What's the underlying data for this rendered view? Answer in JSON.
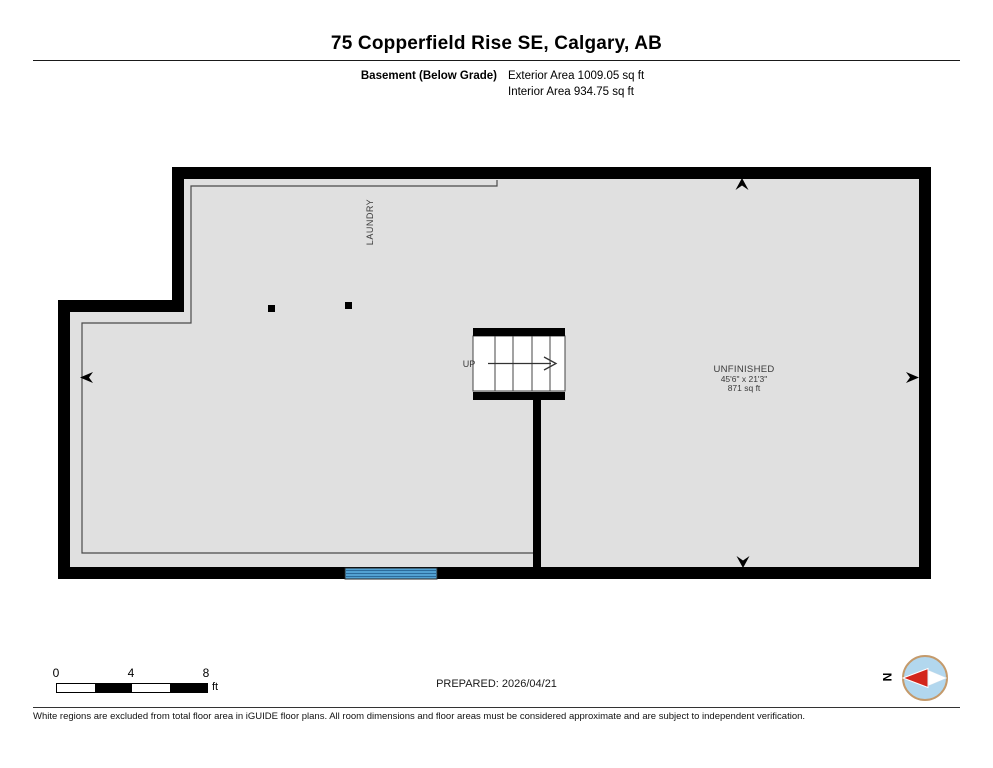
{
  "header": {
    "title": "75 Copperfield Rise SE, Calgary, AB",
    "floor_label": "Basement (Below Grade)",
    "exterior_area": "Exterior Area 1009.05 sq ft",
    "interior_area": "Interior Area 934.75 sq ft"
  },
  "plan": {
    "rooms": {
      "laundry": {
        "label": "LAUNDRY"
      },
      "unfinished": {
        "label": "UNFINISHED",
        "dimensions": "45'6\" x 21'3\"",
        "area": "871 sq ft"
      },
      "stairs": {
        "direction_label": "UP"
      }
    }
  },
  "colors": {
    "wall": "#000000",
    "floor_fill": "#e0e0e0",
    "interior_line": "#4a4a4a",
    "window_fill": "#58a9da",
    "window_stripe": "#2b6b9b",
    "label_text": "#3a3a3a",
    "compass_fill": "#b2d7ee",
    "compass_ring": "#c49a6b",
    "compass_needle_red": "#d3261c"
  },
  "footer": {
    "scale": {
      "ticks": [
        "0",
        "4",
        "8"
      ],
      "unit": "ft"
    },
    "prepared": "PREPARED: 2026/04/21",
    "compass_north_label": "N",
    "disclaimer": "White regions are excluded from total floor area in iGUIDE floor plans. All room dimensions and floor areas must be considered approximate and are subject to independent verification."
  }
}
